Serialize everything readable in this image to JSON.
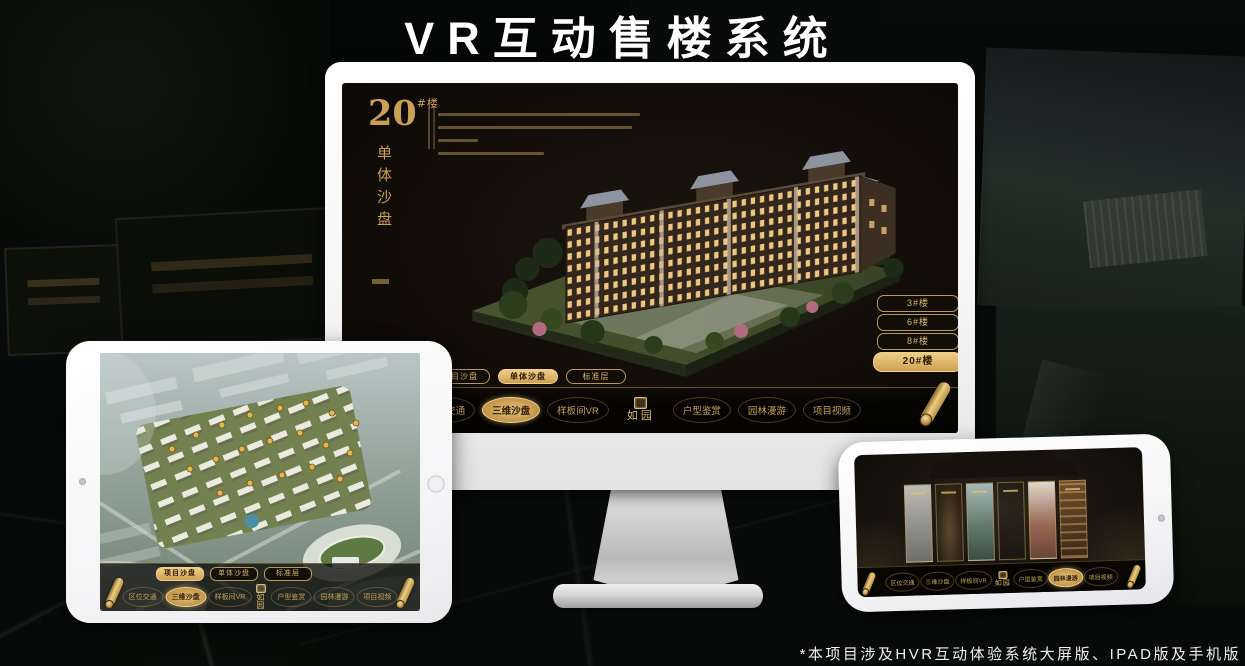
{
  "page": {
    "title": "VR互动售楼系统",
    "footnote": "*本项目涉及HVR互动体验系统大屏版、IPAD版及手机版"
  },
  "brand": {
    "name": "如园"
  },
  "colors": {
    "gold_accent": "#d2a860",
    "active_button_text": "#2a1c08",
    "title_white": "#ffffff"
  },
  "tabs": {
    "items": [
      "项目沙盘",
      "单体沙盘",
      "标准层"
    ]
  },
  "menu": {
    "items": [
      "区位交通",
      "三维沙盘",
      "样板间VR",
      "户型鉴赏",
      "园林漫游",
      "项目视频"
    ]
  },
  "monitor": {
    "building_no": "20",
    "building_unit": "#楼",
    "subtitle_vertical": "单体沙盘",
    "floor_buttons": [
      "3#楼",
      "6#楼",
      "8#楼",
      "20#楼"
    ],
    "active_floor": "20#楼"
  }
}
